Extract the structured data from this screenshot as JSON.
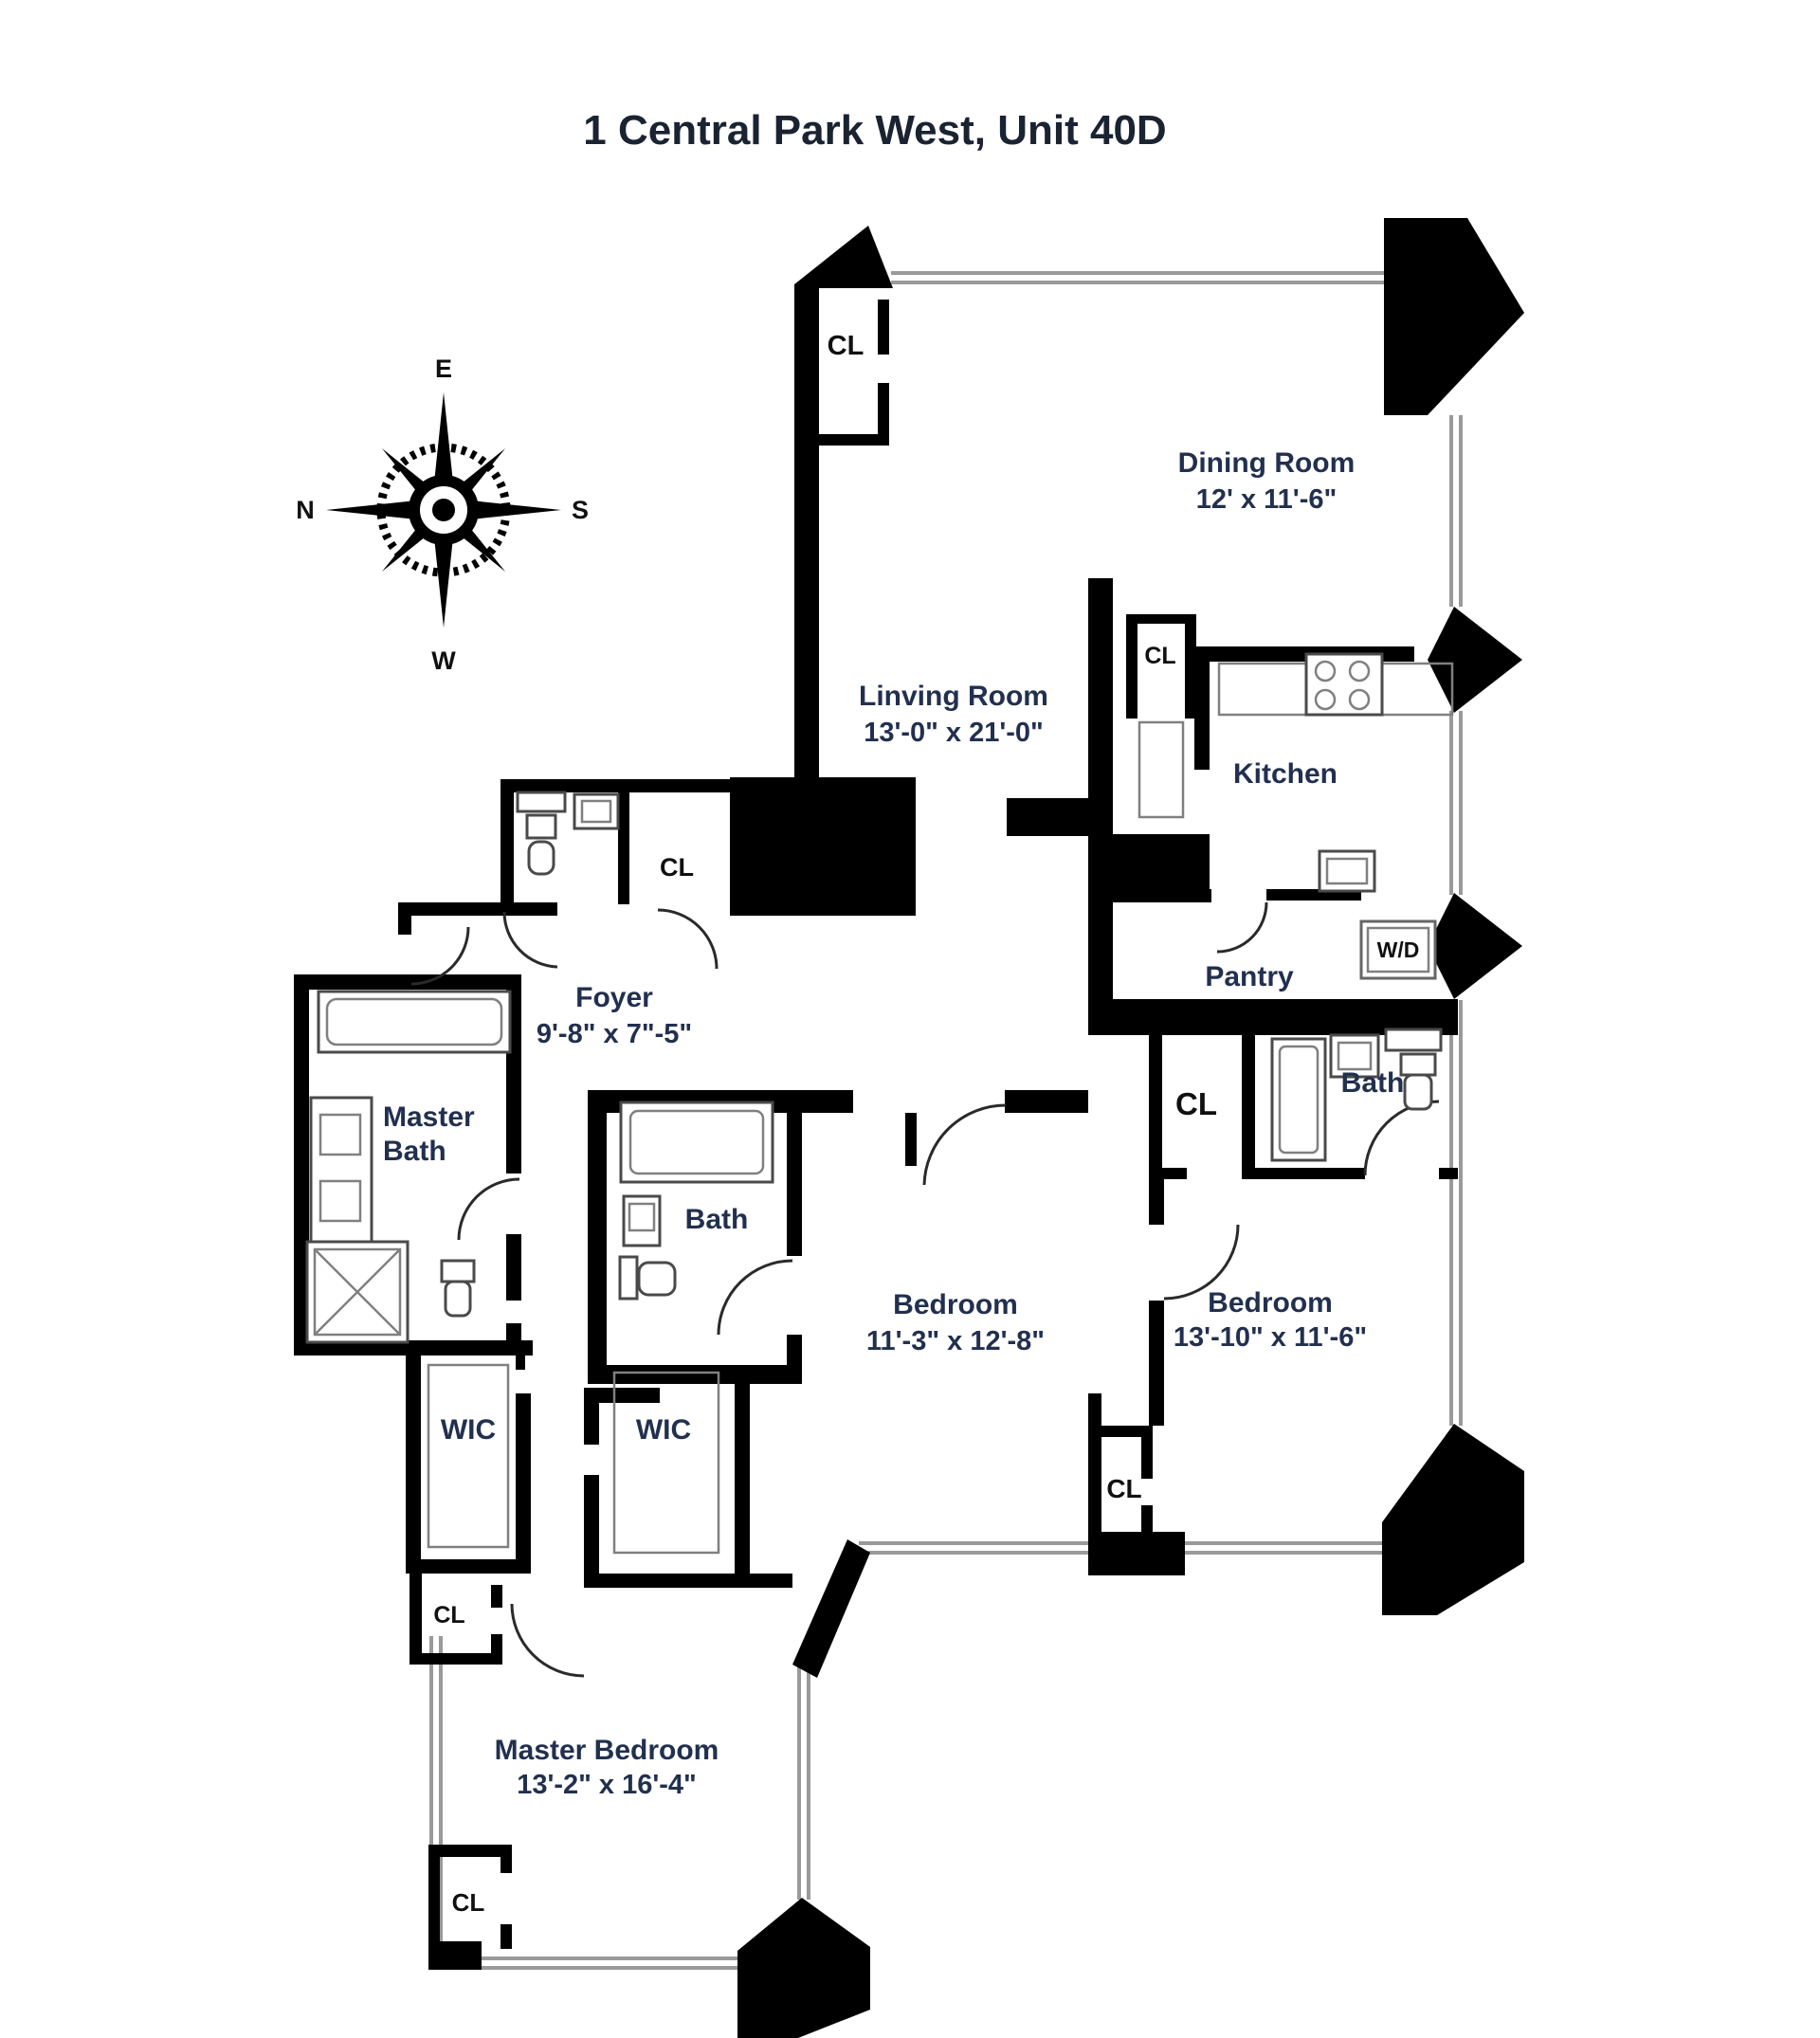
{
  "title": "1 Central Park West, Unit 40D",
  "compass": {
    "top": "E",
    "right": "S",
    "bottom": "W",
    "left": "N"
  },
  "rooms": {
    "dining": {
      "name": "Dining Room",
      "dims": "12' x 11'-6\""
    },
    "living": {
      "name": "Linving Room",
      "dims": "13'-0\" x 21'-0\""
    },
    "kitchen": {
      "name": "Kitchen"
    },
    "pantry": {
      "name": "Pantry"
    },
    "foyer": {
      "name": "Foyer",
      "dims": "9'-8\" x 7\"-5\""
    },
    "master_bath": {
      "line1": "Master",
      "line2": "Bath"
    },
    "bath_middle": {
      "name": "Bath"
    },
    "bath_right": {
      "name": "Bath"
    },
    "bedroom_middle": {
      "name": "Bedroom",
      "dims": "11'-3\" x 12'-8\""
    },
    "bedroom_right": {
      "name": "Bedroom",
      "dims": "13'-10\" x 11'-6\""
    },
    "master_bedroom": {
      "name": "Master Bedroom",
      "dims": "13'-2\" x 16'-4\""
    },
    "wic_left": {
      "name": "WIC"
    },
    "wic_right": {
      "name": "WIC"
    }
  },
  "closets": {
    "living_top": "CL",
    "kitchen": "CL",
    "foyer": "CL",
    "hall": "CL",
    "between_bedrooms": "CL",
    "master_top": "CL",
    "master_bottom": "CL"
  },
  "appliances": {
    "washer_dryer": "W/D"
  },
  "colors": {
    "wall": "#000000",
    "window": "#9a9a9a",
    "label": "#22304f",
    "fixture": "#4a4a4a"
  }
}
